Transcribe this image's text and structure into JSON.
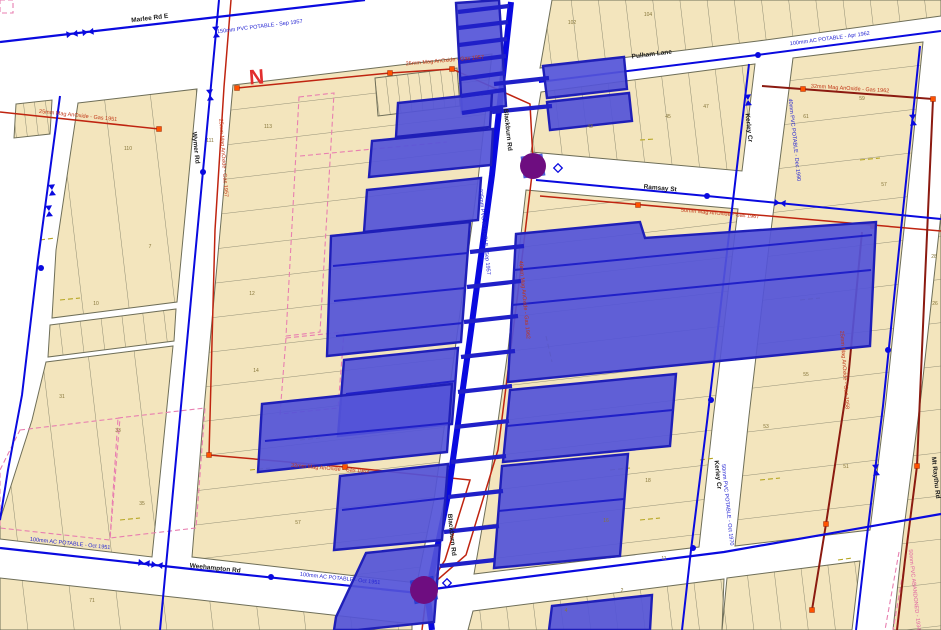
{
  "map_type": "GIS cadastral parcel and utility network map",
  "north_label": "N",
  "colors": {
    "road": "#ffffff",
    "parcel_fill": "#f3e5bd",
    "parcel_line": "#75755f",
    "block_outline": "#6e6e58",
    "water_main_blue": "#0a0adf",
    "selection_fill": "#5454d8",
    "selection_border": "#1f1fb8",
    "gas_main_red": "#bf2410",
    "gas_main_dark": "#8b1a10",
    "gas_node_orange": "#ff5200",
    "pink_dashed": "#e87fb0",
    "hatch_orange": "#e08560",
    "hatch_pink": "#eb9fb5",
    "olive_dash": "#b5a520",
    "junction_purple": "#6e0d80",
    "north_red": "#e22e2e"
  },
  "streets": {
    "marlee": "Marlee Rd E",
    "wymer": "Wymer Rd",
    "blackburn": "Blackburn Rd",
    "ramsay": "Ramsay St",
    "kerley": "Kerley Cr",
    "weehampton": "Weehampton Rd",
    "pulham": "Pulham Lane",
    "mtraythu": "Mt Raythu Rd"
  },
  "water_annotations": {
    "marlee": "150mm PVC POTABLE - Sep 1957",
    "blackburn": "225mm PVC POTABLE - Sep 1957",
    "weehampton_w": "100mm AC POTABLE - Oct 1951",
    "weehampton_e": "100mm AC POTABLE - Oct 1951",
    "kerley": "50mm PVC POTABLE - Oct 1970",
    "kerley_e": "40mm PVC POTABLE - Dec 1990",
    "lane": "100mm AC POTABLE - Apr 1962",
    "abandoned": "50mm PVC ABANDONED - 1934"
  },
  "gas_annotations": {
    "top": "25mm Mag AnOxide - Gas 1957",
    "left_lane": "25mm Mag AnOxide - Gas 1951",
    "mid": "32mm Mag AnOxide - Gas 1962",
    "blackburn": "40mm Mag AnOxide - Gas 1962",
    "top_right": "32mm Mag AnOxide - Gas 1962",
    "ramsay": "50mm Mag AnOxide - Gas 1967",
    "wymer": "25mm Mag AnOxide - Gas 1957",
    "east": "25mm Mag AnOxide - Gas 1958"
  },
  "parcel_numbers": [
    {
      "n": "110"
    },
    {
      "n": "111"
    },
    {
      "n": "113"
    },
    {
      "n": "7"
    },
    {
      "n": "10"
    },
    {
      "n": "12"
    },
    {
      "n": "14"
    },
    {
      "n": "31"
    },
    {
      "n": "33"
    },
    {
      "n": "35"
    },
    {
      "n": "57"
    },
    {
      "n": "102"
    },
    {
      "n": "104"
    },
    {
      "n": "43"
    },
    {
      "n": "45"
    },
    {
      "n": "47"
    },
    {
      "n": "61"
    },
    {
      "n": "59"
    },
    {
      "n": "57"
    },
    {
      "n": "55"
    },
    {
      "n": "53"
    },
    {
      "n": "51"
    },
    {
      "n": "18"
    },
    {
      "n": "16"
    },
    {
      "n": "26"
    },
    {
      "n": "28"
    },
    {
      "n": "2"
    },
    {
      "n": "4"
    },
    {
      "n": "71"
    },
    {
      "n": "11"
    }
  ]
}
